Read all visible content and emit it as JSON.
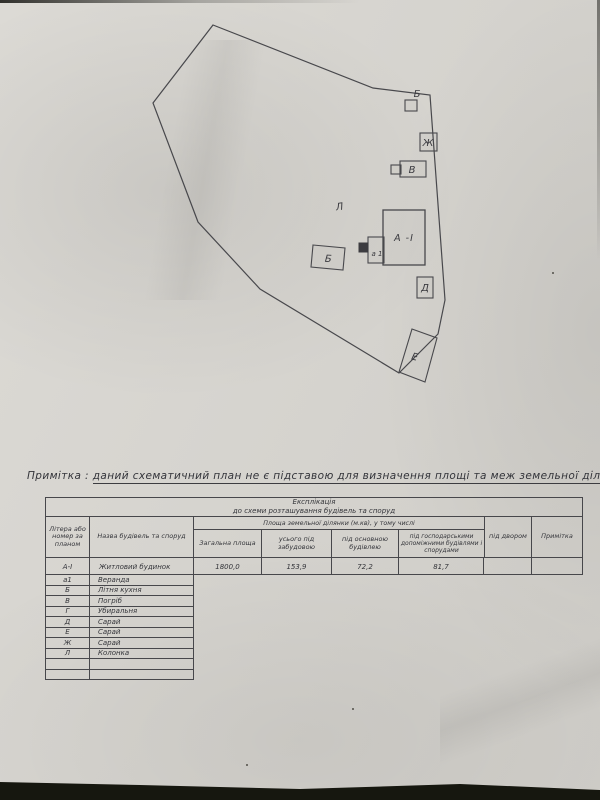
{
  "note": {
    "label": "Примітка :",
    "text": "даний схематичний план не є підставою для визначення площі та меж земельної ділянки"
  },
  "plan": {
    "labels": {
      "b_top": "Б",
      "zh": "Ж",
      "v": "В",
      "l": "Л",
      "house": "А -І",
      "a1": "а 1",
      "b": "Б",
      "d": "Д",
      "e": "Е"
    }
  },
  "exposition": {
    "title1": "Експлікація",
    "title2": "до схеми розташування будівель та споруд",
    "columns": {
      "letter": "Літера або номер за планом",
      "name": "Назва будівель та споруд",
      "area_span": "Площа земельної ділянки (м.кв), у тому числі",
      "total": "Загальна площа",
      "built": "усього під забудовою",
      "main_building": "під основною будівлею",
      "household": "під господарськими допоміжними будівлями і спорудами",
      "yard": "під двором",
      "remark": "Примітка"
    },
    "main_row": {
      "letter": "А-І",
      "name": "Житловий будинок",
      "total": "1800,0",
      "built": "153,9",
      "main_building": "72,2",
      "household": "81,7",
      "yard": "",
      "remark": ""
    },
    "rows": [
      {
        "letter": "а1",
        "name": "Веранда"
      },
      {
        "letter": "Б",
        "name": "Літня кухня"
      },
      {
        "letter": "В",
        "name": "Погріб"
      },
      {
        "letter": "Г",
        "name": "Убиральня"
      },
      {
        "letter": "Д",
        "name": "Сарай"
      },
      {
        "letter": "Е",
        "name": "Сарай"
      },
      {
        "letter": "Ж",
        "name": "Сарай"
      },
      {
        "letter": "Л",
        "name": "Колонка"
      },
      {
        "letter": "",
        "name": ""
      },
      {
        "letter": "",
        "name": ""
      }
    ]
  },
  "colors": {
    "paper": "#d6d4cf",
    "ink": "#47474b",
    "background_dark": "#16170f"
  }
}
